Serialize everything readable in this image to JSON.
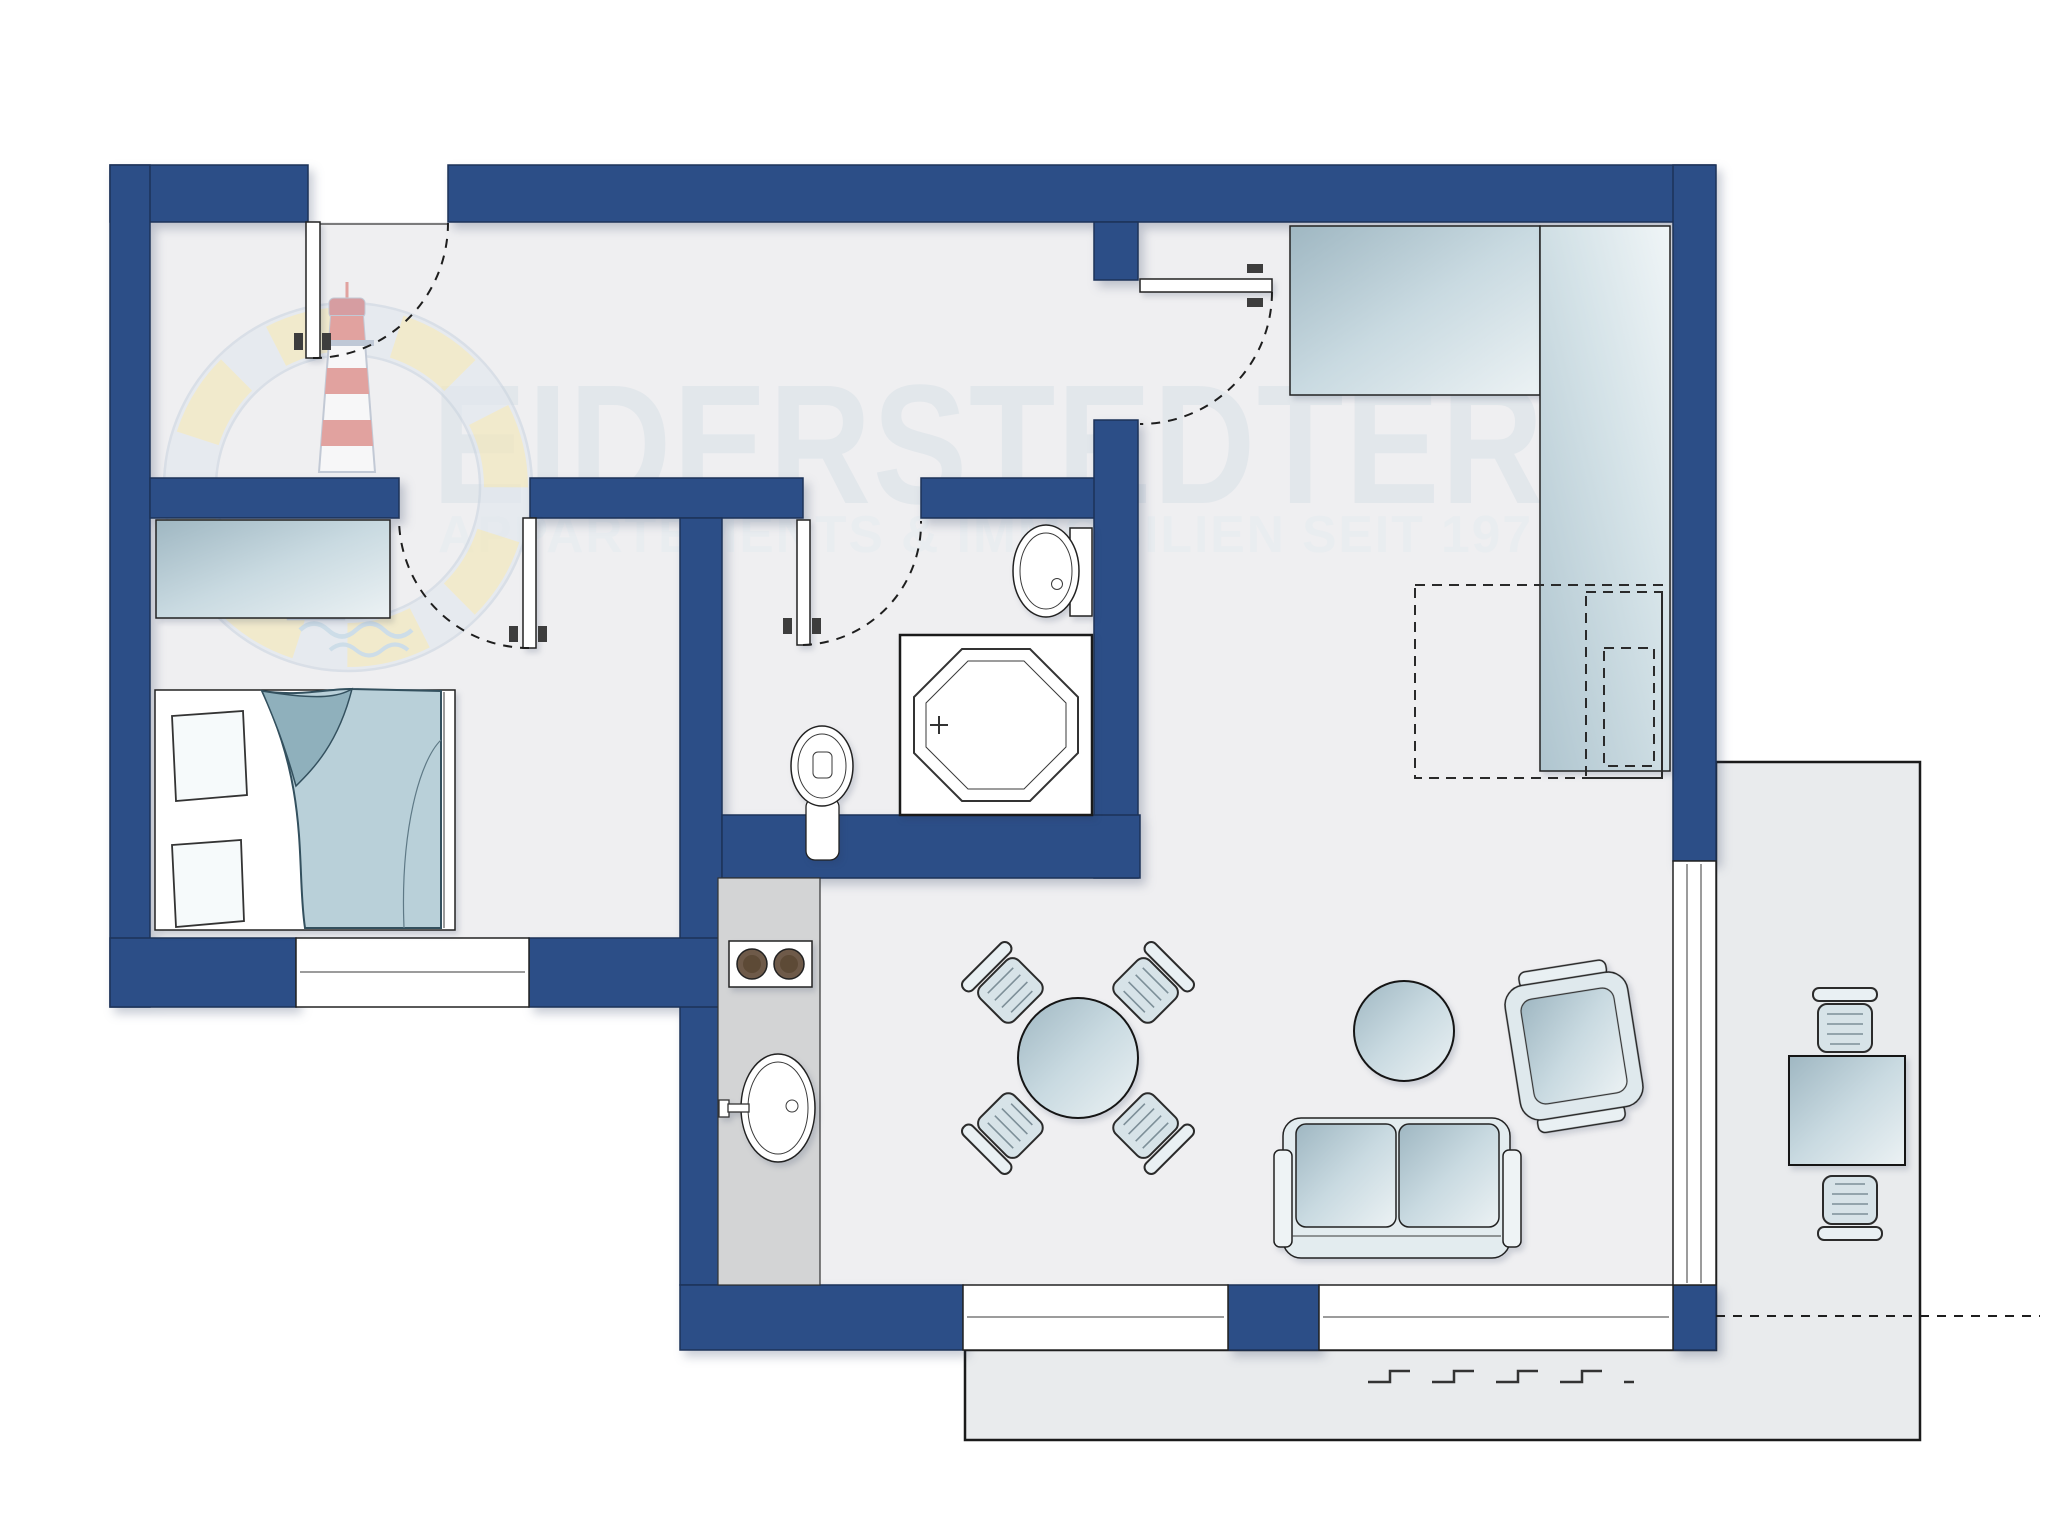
{
  "watermark": {
    "line1": "EIDERSTEDTER",
    "line2": "APPARTEMENTS & IMMOBILIEN SEIT 197",
    "logo": "lifering-lighthouse-logo"
  },
  "colors": {
    "wall": "#2C4E87",
    "wall_outline": "#1C3258",
    "floor": "#EFEFF1",
    "terrace": "#E9EBED",
    "counter": "#D3D4D5",
    "furniture_light": "#ECF2F4",
    "furniture_mid": "#9FB7C2",
    "duvet": "#B9D0D9",
    "burner": "#6E5A49",
    "logo_yellow": "#F4E5AB",
    "logo_red": "#D65C55",
    "logo_ring": "#DFE5ED"
  },
  "elements": [
    "entrance-door",
    "bedroom-door",
    "bathroom-door",
    "living-room-door",
    "bedroom-window",
    "living-window-1",
    "living-window-2",
    "terrace-sliding-door",
    "bed",
    "pillows",
    "duvet",
    "bedroom-dresser",
    "shower",
    "toilet",
    "washbasin",
    "kitchen-counter",
    "stove",
    "kitchen-sink",
    "dining-table",
    "dining-chairs",
    "sofa",
    "side-table",
    "armchair",
    "wardrobe-wide",
    "wardrobe-tall",
    "planned-fixture-dashed",
    "terrace",
    "terrace-table",
    "terrace-chairs",
    "awning-symbol"
  ]
}
